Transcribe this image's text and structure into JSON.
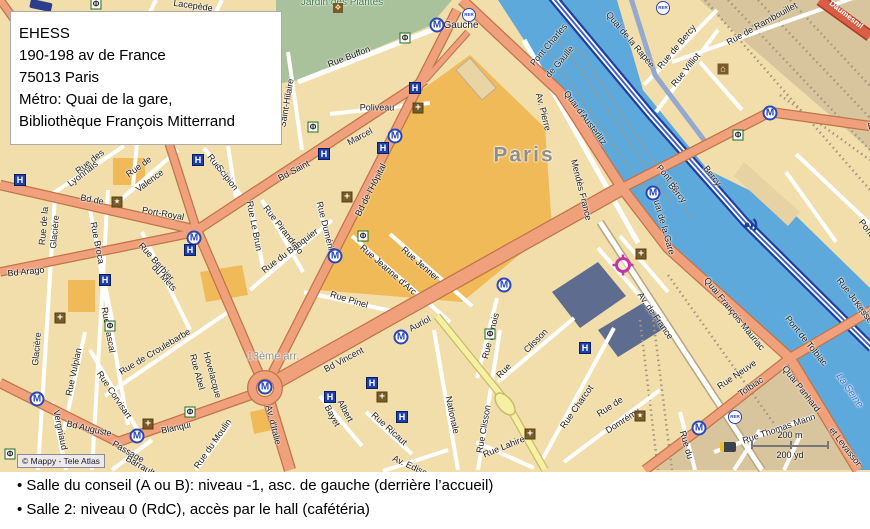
{
  "address_box": {
    "lines": [
      "EHESS",
      "190-198 av de France",
      "75013 Paris",
      "Métro: Quai de la gare,",
      "Bibliothèque François Mitterrand"
    ]
  },
  "footer": {
    "lines": [
      "• Salle du conseil (A ou B): niveau -1, asc. de gauche (derrière l’accueil)",
      "• Salle 2: niveau 0 (RdC), accès par le hall (cafétéria)"
    ]
  },
  "map": {
    "copyright": "© Mappy - Tele Atlas",
    "scale": {
      "metric": "200 m",
      "imperial": "200 yd"
    },
    "colors": {
      "land": "#F2DEAB",
      "land_tan": "#D9C59D",
      "park": "#A9C29C",
      "water": "#5EA9DC",
      "road_major": "#F0A17B",
      "road_casing": "#C0744A",
      "road_motorway": "#1E3EA0",
      "road_yellow": "#F6F0A2",
      "landmark": "#F0BA58",
      "building_dark": "#5E6C90",
      "metro_blue": "#2A47B8",
      "target_magenta": "#C536A4"
    },
    "labels": [
      {
        "t": "Lacepède",
        "x": 193,
        "y": 6,
        "r": 8
      },
      {
        "t": "Jardin des Plantes",
        "x": 342,
        "y": 3,
        "r": 0,
        "c": "#3F7A44",
        "s": 10
      },
      {
        "t": "Rue Buffon",
        "x": 349,
        "y": 57,
        "r": -21
      },
      {
        "t": "Poliveau",
        "x": 377,
        "y": 108,
        "r": 0
      },
      {
        "t": "Saint-Hilaire",
        "x": 287,
        "y": 103,
        "r": -80
      },
      {
        "t": "Gauche",
        "x": 461,
        "y": 26,
        "r": 0,
        "s": 10
      },
      {
        "t": "Pont Charles",
        "x": 549,
        "y": 45,
        "r": -50
      },
      {
        "t": "de Gaulle",
        "x": 560,
        "y": 62,
        "r": -50
      },
      {
        "t": "Quai d'Austerlitz",
        "x": 585,
        "y": 118,
        "r": 53
      },
      {
        "t": "Av. Pierre",
        "x": 543,
        "y": 112,
        "r": 76
      },
      {
        "t": "Mendès France",
        "x": 581,
        "y": 190,
        "r": 76
      },
      {
        "t": "Paris",
        "x": 524,
        "y": 155,
        "r": 0,
        "s": 21,
        "c": "#8F8F88",
        "b": 1,
        "ls": 2
      },
      {
        "t": "Rue de Bercy",
        "x": 677,
        "y": 47,
        "r": -50
      },
      {
        "t": "Rue de Rambouillet",
        "x": 762,
        "y": 24,
        "r": -29
      },
      {
        "t": "Rue Villiot",
        "x": 686,
        "y": 70,
        "r": -51
      },
      {
        "t": "Daumesnil",
        "x": 846,
        "y": 15,
        "r": 38,
        "c": "#FFFFFF",
        "s": 8,
        "b": 1
      },
      {
        "t": "Quai de la Rapée",
        "x": 630,
        "y": 40,
        "r": 50
      },
      {
        "t": "Bercy",
        "x": 712,
        "y": 176,
        "r": 52
      },
      {
        "t": "Pont de",
        "x": 668,
        "y": 178,
        "r": 50
      },
      {
        "t": "Bercy",
        "x": 677,
        "y": 193,
        "r": 50
      },
      {
        "t": "Quai de la Gare",
        "x": 663,
        "y": 224,
        "r": 74
      },
      {
        "t": "Quai François Mauriac",
        "x": 734,
        "y": 314,
        "r": 51
      },
      {
        "t": "Pont de Tolbiac",
        "x": 806,
        "y": 341,
        "r": 51
      },
      {
        "t": "Quai Panhard",
        "x": 801,
        "y": 389,
        "r": 52
      },
      {
        "t": "et Levassor",
        "x": 845,
        "y": 447,
        "r": 52
      },
      {
        "t": "La Seine",
        "x": 849,
        "y": 391,
        "r": 55,
        "c": "#3A6BC8",
        "i": 1,
        "s": 10
      },
      {
        "t": "Rue Neuve",
        "x": 737,
        "y": 375,
        "r": -34
      },
      {
        "t": "Tolbiac",
        "x": 751,
        "y": 387,
        "r": -34
      },
      {
        "t": "Rue Thomas Mann",
        "x": 779,
        "y": 429,
        "r": -19
      },
      {
        "t": "Rue du",
        "x": 686,
        "y": 445,
        "r": 74
      },
      {
        "t": "Rue de",
        "x": 610,
        "y": 407,
        "r": -33
      },
      {
        "t": "Domrémy",
        "x": 623,
        "y": 421,
        "r": -33
      },
      {
        "t": "Rue Charcot",
        "x": 577,
        "y": 407,
        "r": -55
      },
      {
        "t": "Rue Clisson",
        "x": 484,
        "y": 429,
        "r": -80
      },
      {
        "t": "Rue",
        "x": 504,
        "y": 371,
        "r": -45
      },
      {
        "t": "Clisson",
        "x": 536,
        "y": 341,
        "r": -45
      },
      {
        "t": "Rue Dunois",
        "x": 491,
        "y": 336,
        "r": -76
      },
      {
        "t": "Rue Lahire",
        "x": 504,
        "y": 447,
        "r": -22
      },
      {
        "t": "Nationale",
        "x": 452,
        "y": 415,
        "r": 78
      },
      {
        "t": "Rue Ricaut",
        "x": 389,
        "y": 429,
        "r": 42
      },
      {
        "t": "Albert",
        "x": 345,
        "y": 411,
        "r": 62
      },
      {
        "t": "Bayet",
        "x": 332,
        "y": 416,
        "r": 62
      },
      {
        "t": "Av. Edison",
        "x": 412,
        "y": 467,
        "r": 25
      },
      {
        "t": "Rue du Moulin",
        "x": 213,
        "y": 444,
        "r": -55
      },
      {
        "t": "Passage",
        "x": 128,
        "y": 452,
        "r": 30
      },
      {
        "t": "Barrault",
        "x": 140,
        "y": 466,
        "r": 30
      },
      {
        "t": "Vergniaud",
        "x": 60,
        "y": 430,
        "r": 78
      },
      {
        "t": "Bd Auguste",
        "x": 89,
        "y": 429,
        "r": 13
      },
      {
        "t": "Blanqui",
        "x": 176,
        "y": 428,
        "r": -12
      },
      {
        "t": "Av. d'Italie",
        "x": 273,
        "y": 425,
        "r": 76
      },
      {
        "t": "13ème arr.",
        "x": 273,
        "y": 357,
        "r": 0,
        "s": 11,
        "c": "#8F8F88"
      },
      {
        "t": "Rue Abel",
        "x": 197,
        "y": 372,
        "r": 75
      },
      {
        "t": "Hovelacque",
        "x": 212,
        "y": 375,
        "r": 75
      },
      {
        "t": "Rue de Croulebarbe",
        "x": 155,
        "y": 352,
        "r": -31
      },
      {
        "t": "Rue Corvisart",
        "x": 114,
        "y": 395,
        "r": 56
      },
      {
        "t": "Rue Vulpian",
        "x": 74,
        "y": 372,
        "r": -78
      },
      {
        "t": "Rue de la",
        "x": 44,
        "y": 226,
        "r": -85
      },
      {
        "t": "Glacière",
        "x": 55,
        "y": 232,
        "r": -85
      },
      {
        "t": "Glacière",
        "x": 37,
        "y": 349,
        "r": -85
      },
      {
        "t": "Rue Broca",
        "x": 97,
        "y": 243,
        "r": 79
      },
      {
        "t": "Rue Pascal",
        "x": 108,
        "y": 330,
        "r": 80
      },
      {
        "t": "Rue Berbier",
        "x": 156,
        "y": 262,
        "r": 48
      },
      {
        "t": "du Mets",
        "x": 164,
        "y": 278,
        "r": 48
      },
      {
        "t": "Bd de",
        "x": 92,
        "y": 200,
        "r": 11
      },
      {
        "t": "Port-Royal",
        "x": 163,
        "y": 214,
        "r": 10
      },
      {
        "t": "Bd Arago",
        "x": 26,
        "y": 272,
        "r": -6
      },
      {
        "t": "Rue des",
        "x": 90,
        "y": 162,
        "r": -38
      },
      {
        "t": "Lyonnais",
        "x": 83,
        "y": 174,
        "r": -38
      },
      {
        "t": "Rue de",
        "x": 139,
        "y": 167,
        "r": -36
      },
      {
        "t": "Valence",
        "x": 150,
        "y": 181,
        "r": -36
      },
      {
        "t": "Rue",
        "x": 214,
        "y": 162,
        "r": 52
      },
      {
        "t": "Scipion",
        "x": 227,
        "y": 178,
        "r": 52
      },
      {
        "t": "Bd Saint",
        "x": 294,
        "y": 171,
        "r": -28
      },
      {
        "t": "Marcel",
        "x": 360,
        "y": 137,
        "r": -28
      },
      {
        "t": "Bd de l'Hôpital",
        "x": 371,
        "y": 190,
        "r": -63
      },
      {
        "t": "Rue Le Brun",
        "x": 254,
        "y": 226,
        "r": 79
      },
      {
        "t": "Rue Pirandello",
        "x": 283,
        "y": 230,
        "r": 52
      },
      {
        "t": "Rue du Banquier",
        "x": 290,
        "y": 251,
        "r": -37
      },
      {
        "t": "Rue Duméril",
        "x": 325,
        "y": 226,
        "r": 76
      },
      {
        "t": "Rue Jeanne d'Arc",
        "x": 388,
        "y": 270,
        "r": 41
      },
      {
        "t": "Rue Jenner",
        "x": 420,
        "y": 264,
        "r": 41
      },
      {
        "t": "Rue Pinel",
        "x": 349,
        "y": 300,
        "r": 17
      },
      {
        "t": "Bd Vincent",
        "x": 344,
        "y": 360,
        "r": -28
      },
      {
        "t": "Auriol",
        "x": 420,
        "y": 324,
        "r": -28
      },
      {
        "t": "Av. de France",
        "x": 655,
        "y": 316,
        "r": 55
      },
      {
        "t": "Rue Joseph",
        "x": 853,
        "y": 298,
        "r": 52
      },
      {
        "t": "Kessel",
        "x": 864,
        "y": 313,
        "r": 52
      },
      {
        "t": "Pont",
        "x": 866,
        "y": 228,
        "r": 52
      },
      {
        "t": "Bd de Bercy",
        "x": 892,
        "y": 122,
        "r": -12
      }
    ],
    "icons": [
      {
        "t": "metro",
        "x": 437,
        "y": 25
      },
      {
        "t": "metro",
        "x": 395,
        "y": 136
      },
      {
        "t": "metro",
        "x": 335,
        "y": 256
      },
      {
        "t": "metro",
        "x": 401,
        "y": 337
      },
      {
        "t": "metro",
        "x": 504,
        "y": 285
      },
      {
        "t": "metro",
        "x": 653,
        "y": 193
      },
      {
        "t": "metro",
        "x": 770,
        "y": 113
      },
      {
        "t": "metro",
        "x": 194,
        "y": 238
      },
      {
        "t": "metro",
        "x": 37,
        "y": 399
      },
      {
        "t": "metro",
        "x": 137,
        "y": 436
      },
      {
        "t": "metro",
        "x": 265,
        "y": 387
      },
      {
        "t": "metro",
        "x": 699,
        "y": 428
      },
      {
        "t": "rer",
        "x": 469,
        "y": 15
      },
      {
        "t": "rer",
        "x": 663,
        "y": 8
      },
      {
        "t": "rer",
        "x": 735,
        "y": 417
      },
      {
        "t": "hotel",
        "x": 20,
        "y": 180
      },
      {
        "t": "hotel",
        "x": 198,
        "y": 160
      },
      {
        "t": "hotel",
        "x": 324,
        "y": 154
      },
      {
        "t": "hotel",
        "x": 383,
        "y": 148
      },
      {
        "t": "hotel",
        "x": 415,
        "y": 88
      },
      {
        "t": "hotel",
        "x": 190,
        "y": 250
      },
      {
        "t": "hotel",
        "x": 105,
        "y": 280
      },
      {
        "t": "hotel",
        "x": 330,
        "y": 397
      },
      {
        "t": "hotel",
        "x": 372,
        "y": 383
      },
      {
        "t": "hotel",
        "x": 402,
        "y": 417
      },
      {
        "t": "hotel",
        "x": 585,
        "y": 348
      },
      {
        "t": "church",
        "x": 418,
        "y": 108
      },
      {
        "t": "church",
        "x": 347,
        "y": 197
      },
      {
        "t": "church",
        "x": 60,
        "y": 318
      },
      {
        "t": "church",
        "x": 641,
        "y": 254
      },
      {
        "t": "church",
        "x": 382,
        "y": 397
      },
      {
        "t": "church",
        "x": 530,
        "y": 434
      },
      {
        "t": "church",
        "x": 148,
        "y": 424
      },
      {
        "t": "star",
        "x": 640,
        "y": 416
      },
      {
        "t": "star",
        "x": 117,
        "y": 202
      },
      {
        "t": "bank",
        "x": 405,
        "y": 38
      },
      {
        "t": "bank",
        "x": 313,
        "y": 127
      },
      {
        "t": "bank",
        "x": 110,
        "y": 326
      },
      {
        "t": "bank",
        "x": 363,
        "y": 236
      },
      {
        "t": "bank",
        "x": 490,
        "y": 334
      },
      {
        "t": "bank",
        "x": 190,
        "y": 412
      },
      {
        "t": "bank",
        "x": 10,
        "y": 454
      },
      {
        "t": "bank",
        "x": 738,
        "y": 135
      },
      {
        "t": "bank",
        "x": 96,
        "y": 4
      },
      {
        "t": "park",
        "x": 338,
        "y": 8
      },
      {
        "t": "monument",
        "x": 723,
        "y": 69
      },
      {
        "t": "train",
        "x": 728,
        "y": 447
      },
      {
        "t": "target",
        "x": 612,
        "y": 254
      },
      {
        "t": "radar",
        "x": 743,
        "y": 217
      }
    ]
  }
}
